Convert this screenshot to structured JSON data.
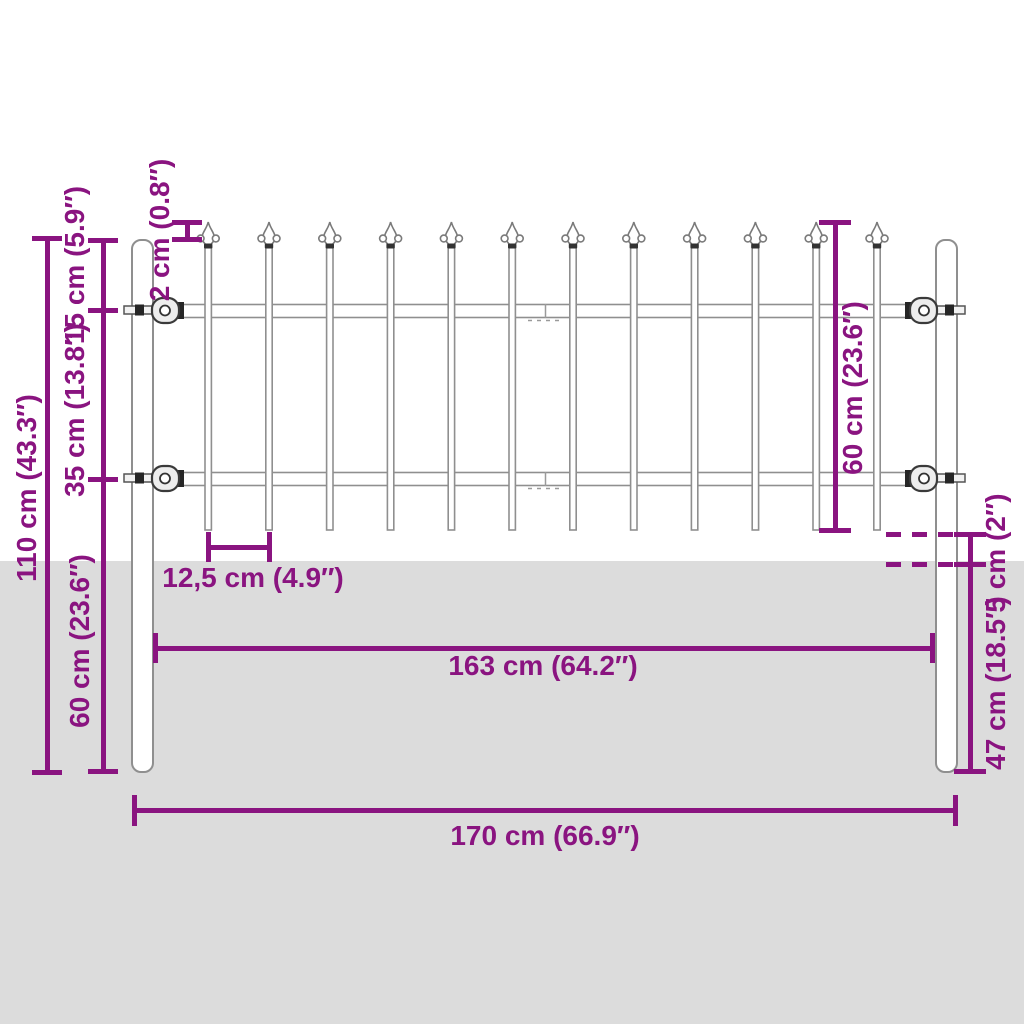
{
  "title": "Garden fence with spear top — dimension diagram",
  "colors": {
    "dimension": "#8A1480",
    "ground": "#DCDCDC",
    "outline": "#8F8F8F"
  },
  "labels": {
    "post_total_height": "110 cm (43.3″)",
    "top_rail_offset": "15 cm (5.9″)",
    "rail_spacing": "35 cm (13.8″)",
    "post_lower_section": "60 cm (23.6″)",
    "spear_protrusion": "2 cm (0.8″)",
    "picket_height": "60 cm (23.6″)",
    "picket_spacing": "12,5 cm (4.9″)",
    "ground_clearance": "5 cm (2″)",
    "post_depth_below_ground": "47 cm (18.5″)",
    "panel_width": "163 cm (64.2″)",
    "total_width": "170 cm (66.9″)"
  }
}
